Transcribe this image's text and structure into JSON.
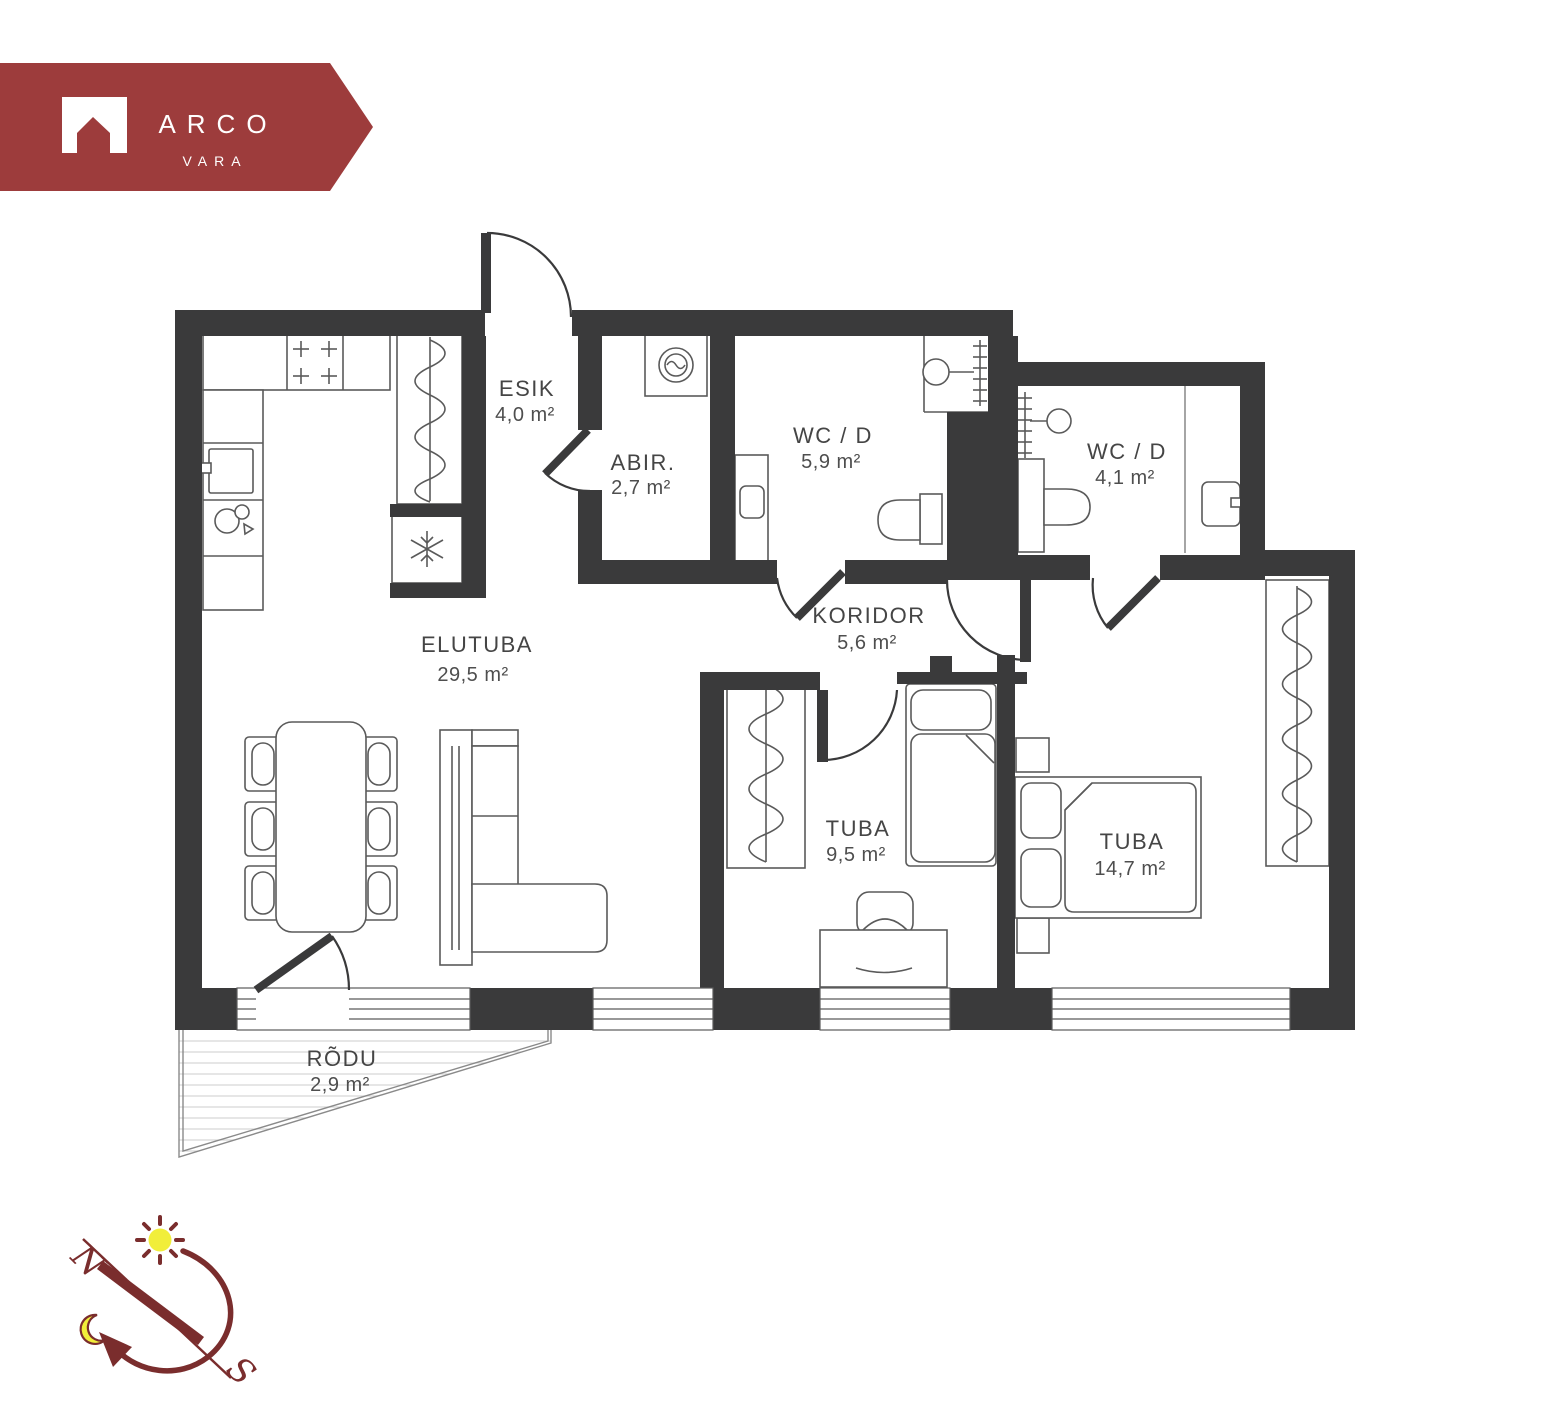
{
  "logo": {
    "brand": "ARCO",
    "sub": "VARA"
  },
  "colors": {
    "banner_red": "#9d3c3c",
    "compass_red": "#7a2d2d",
    "sun_yellow": "#f1ee3a",
    "wall_dark": "#3a3a3b",
    "label_gray": "#454545"
  },
  "rooms": [
    {
      "id": "esik",
      "name": "ESIK",
      "area": "4,0 m²"
    },
    {
      "id": "abir",
      "name": "ABIR.",
      "area": "2,7 m²"
    },
    {
      "id": "wcd-1",
      "name": "WC / D",
      "area": "5,9 m²"
    },
    {
      "id": "wcd-2",
      "name": "WC / D",
      "area": "4,1 m²"
    },
    {
      "id": "koridor",
      "name": "KORIDOR",
      "area": "5,6 m²"
    },
    {
      "id": "elutuba",
      "name": "ELUTUBA",
      "area": "29,5 m²"
    },
    {
      "id": "tuba-1",
      "name": "TUBA",
      "area": "9,5 m²"
    },
    {
      "id": "tuba-2",
      "name": "TUBA",
      "area": "14,7 m²"
    },
    {
      "id": "rodu",
      "name": "RÕDU",
      "area": "2,9 m²"
    }
  ],
  "compass": {
    "north": "N",
    "south": "S"
  }
}
